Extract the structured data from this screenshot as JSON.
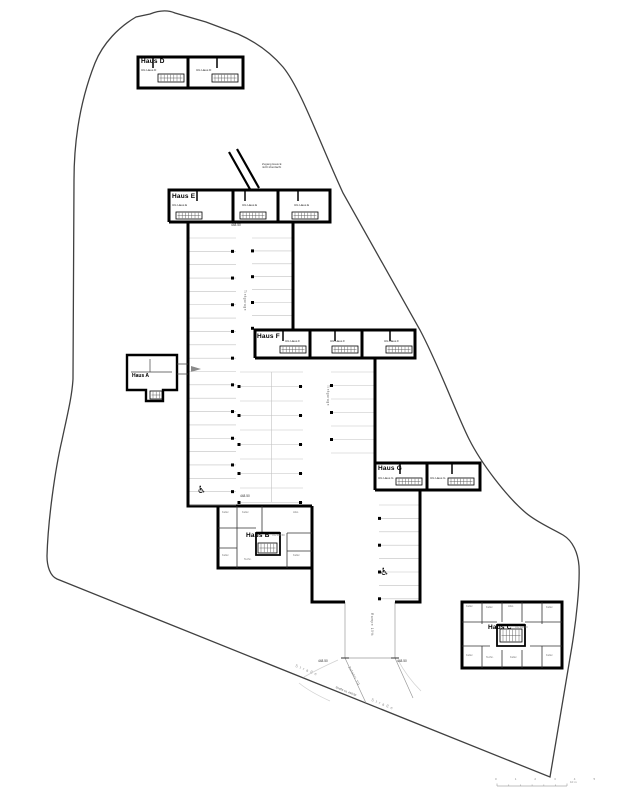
{
  "plan": {
    "houses": {
      "a": "Haus A",
      "b": "Haus B",
      "c": "Haus C",
      "d": "Haus D",
      "e": "Haus E",
      "f": "Haus F",
      "g": "Haus G"
    },
    "units": {
      "d1": "UG Haus D",
      "d2": "UG Haus D",
      "e1": "UG Haus E",
      "e2": "UG Haus E",
      "e3": "UG Haus E",
      "f1": "UG Haus F",
      "f2": "UG Haus F",
      "f3": "UG Haus F",
      "g1": "UG Haus G",
      "g2": "UG Haus G",
      "b_sub": "UG 448.50",
      "c_sub": "UG 448.50"
    },
    "garage": {
      "aisle_label_top": "Tiefgarage",
      "aisle_label_mid": "Tiefgarage",
      "ramp_label": "Rampe 15%",
      "access_label": "Zufahrt TG",
      "elev_top": "448.50",
      "elev_mid": "448.50",
      "elev_ramp_left": "448.50",
      "elev_ramp_right": "448.50"
    },
    "entrance_note_line1": "Zugang Haus E",
    "entrance_note_line2": "nicht überdacht",
    "road": {
      "name_upper": "Straße",
      "name_lower": "Straße",
      "elev_label": "Straße ca. 448.50"
    },
    "rooms_b": [
      "Keller",
      "Keller",
      "Abst.",
      "Keller",
      "Techn.",
      "Keller"
    ],
    "rooms_c": [
      "Keller",
      "Keller",
      "Abst.",
      "Keller",
      "Keller",
      "Techn.",
      "Keller",
      "Keller"
    ],
    "scalebar": {
      "ticks": "0 1 2 3 4 5",
      "unit": "10 m"
    },
    "icons": {
      "wheelchair": "♿"
    }
  }
}
